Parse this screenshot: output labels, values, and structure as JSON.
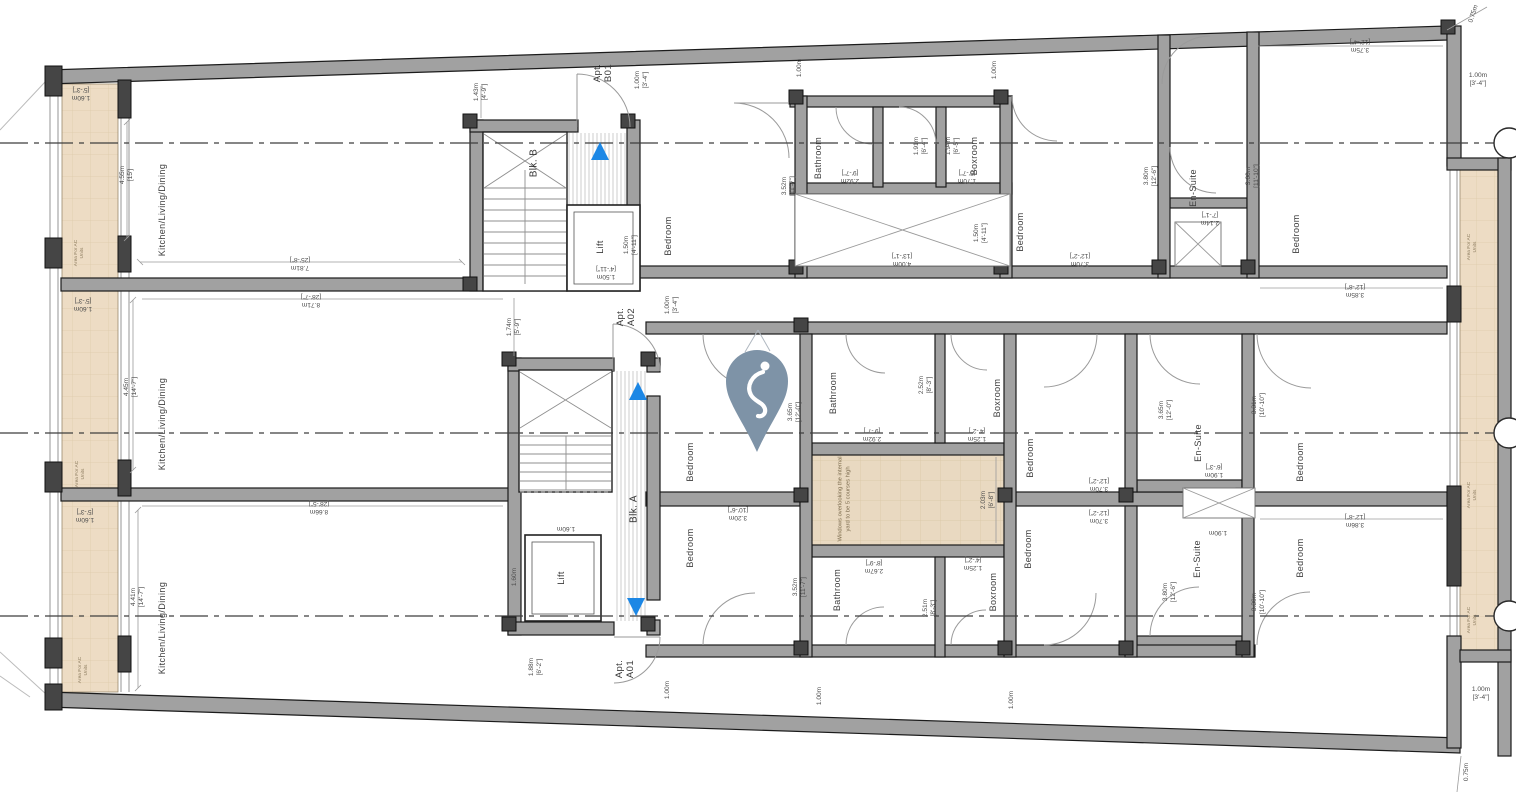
{
  "rooms": {
    "kitchen": "Kitchen/Living/Dining",
    "bedroom": "Bedroom",
    "bathroom": "Bathroom",
    "boxroom": "Boxroom",
    "ensuite": "En-Suite",
    "lift": "Lift"
  },
  "blocks": {
    "b": "Blk. B",
    "a": "Blk. A"
  },
  "apartments": {
    "b01": {
      "l1": "Apt.",
      "l2": "B01"
    },
    "a02": {
      "l1": "Apt.",
      "l2": "A02"
    },
    "a01": {
      "l1": "Apt.",
      "l2": "A01"
    }
  },
  "notes": {
    "yard": "Windows overlooking the internal yard to be 5 courses high",
    "ac": "Area For AC Units"
  },
  "icons": {
    "pin": "location-pin",
    "stair_up": "stair-direction-up-arrow",
    "stair_down": "stair-direction-down-arrow"
  },
  "colors": {
    "wall": "#a1a1a1",
    "wall_edge": "#1b1b1b",
    "ac_area": "#eddcc4",
    "yard": "#e9d9c1",
    "arrow_blue": "#1c87e5",
    "pin": "#7e93a7"
  },
  "dims": {
    "d075": {
      "v": "0.75m",
      "i": ""
    },
    "d100": {
      "v": "1.00m",
      "i": "[3'-4\"]"
    },
    "d100p": {
      "v": "1.00m",
      "i": ""
    },
    "d125": {
      "v": "1.25m",
      "i": "[4'-2\"]"
    },
    "d143": {
      "v": "1.43m",
      "i": "[4'-9\"]"
    },
    "d150": {
      "v": "1.50m",
      "i": "[4'-11\"]"
    },
    "d160": {
      "v": "1.60m",
      "i": "[5'-3\"]"
    },
    "d160p": {
      "v": "1.60m",
      "i": ""
    },
    "d170": {
      "v": "1.70m",
      "i": "[5'-7\"]"
    },
    "d174": {
      "v": "1.74m",
      "i": "[5'-9\"]"
    },
    "d188": {
      "v": "1.88m",
      "i": "[6'-2\"]"
    },
    "d190": {
      "v": "1.90m",
      "i": "[6'-3\"]"
    },
    "d190p": {
      "v": "1.90m",
      "i": ""
    },
    "d191": {
      "v": "1.91m",
      "i": "[6'-4\"]"
    },
    "d194": {
      "v": "1.94m",
      "i": "[6'-5\"]"
    },
    "d203": {
      "v": "2.03m",
      "i": "[6'-8\"]"
    },
    "d214": {
      "v": "2.14m",
      "i": "[7'-1\"]"
    },
    "d251": {
      "v": "2.51m",
      "i": "[8'-3\"]"
    },
    "d252": {
      "v": "2.52m",
      "i": "[8'-3\"]"
    },
    "d267": {
      "v": "2.67m",
      "i": "[8'-9\"]"
    },
    "d292": {
      "v": "2.92m",
      "i": "[9'-7\"]"
    },
    "d320": {
      "v": "3.20m",
      "i": "[10'-6\"]"
    },
    "d330": {
      "v": "3.30m",
      "i": "[10'-10\"]"
    },
    "d331": {
      "v": "3.31m",
      "i": "[10'-10\"]"
    },
    "d352": {
      "v": "3.52m",
      "i": "[11'-7\"]"
    },
    "d360": {
      "v": "3.60m",
      "i": "[11'-10\"]"
    },
    "d365": {
      "v": "3.65m",
      "i": "[12'-0\"]"
    },
    "d370": {
      "v": "3.70m",
      "i": "[12'-2\"]"
    },
    "d375": {
      "v": "3.75m",
      "i": "[12'-4\"]"
    },
    "d380": {
      "v": "3.80m",
      "i": "[12'-6\"]"
    },
    "d385": {
      "v": "3.85m",
      "i": "[12'-8\"]"
    },
    "d386": {
      "v": "3.86m",
      "i": "[12'-8\"]"
    },
    "d400": {
      "v": "4.00m",
      "i": "[13'-1\"]"
    },
    "d441": {
      "v": "4.41m",
      "i": "[14'-7\"]"
    },
    "d445": {
      "v": "4.45m",
      "i": "[14'-7\"]"
    },
    "d455": {
      "v": "4.55m",
      "i": "[15']"
    },
    "d781": {
      "v": "7.81m",
      "i": "[25'-8\"]"
    },
    "d866": {
      "v": "8.66m",
      "i": "[28'-5\"]"
    },
    "d871": {
      "v": "8.71m",
      "i": "[28'-7\"]"
    }
  }
}
